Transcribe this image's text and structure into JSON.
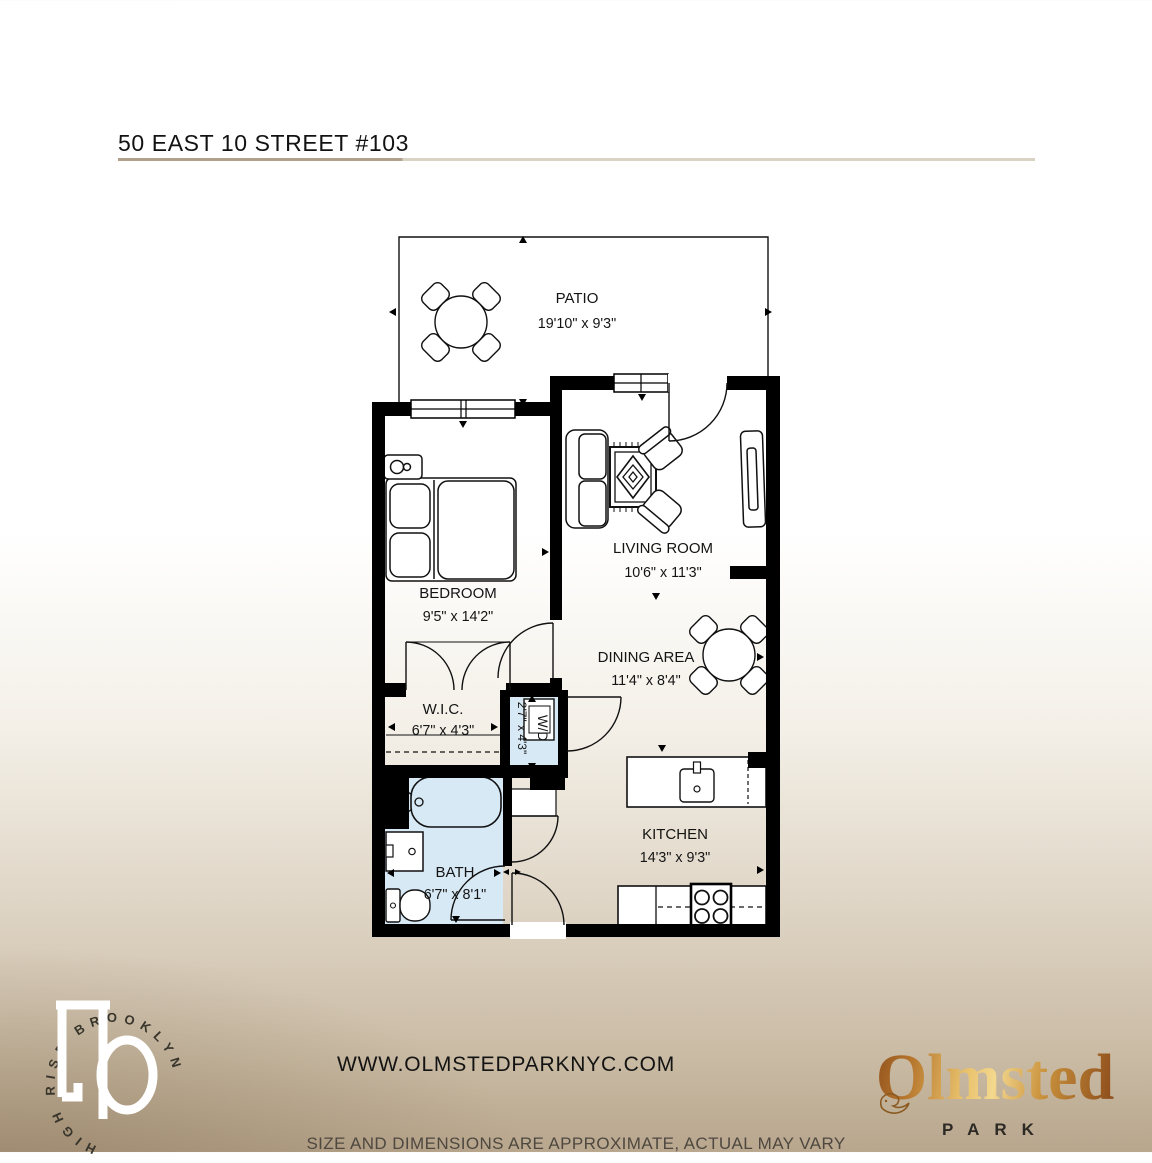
{
  "header": {
    "title": "50 EAST 10 STREET #103"
  },
  "rooms": {
    "patio": {
      "name": "PATIO",
      "dims": "19'10\" x 9'3\""
    },
    "bedroom": {
      "name": "BEDROOM",
      "dims": "9'5\" x 14'2\""
    },
    "living": {
      "name": "LIVING ROOM",
      "dims": "10'6\" x 11'3\""
    },
    "dining": {
      "name": "DINING AREA",
      "dims": "11'4\" x 8'4\""
    },
    "wic": {
      "name": "W.I.C.",
      "dims": "6'7\" x 4'3\""
    },
    "wd": {
      "name": "W/D",
      "dims": "2'7\" x 4'3\""
    },
    "bath": {
      "name": "BATH",
      "dims": "6'7\" x 8'1\""
    },
    "kitchen": {
      "name": "KITCHEN",
      "dims": "14'3\" x 9'3\""
    }
  },
  "footer": {
    "website": "WWW.OLMSTEDPARKNYC.COM",
    "disclaimer": "SIZE AND DIMENSIONS ARE APPROXIMATE, ACTUAL MAY VARY"
  },
  "branding": {
    "circle_text": "HIGH RISE BROOKLYN",
    "brand": "Olmsted",
    "brand_sub": "PARK"
  },
  "colors": {
    "underline_dark": "#b1a18c",
    "underline_light": "#d9d3c3",
    "bath_blue": "#d7e9f5",
    "wall_black": "#000000",
    "gold_dark": "#7c3d15",
    "gold_light": "#f3d88e",
    "background_tan": "#b8a68d"
  }
}
